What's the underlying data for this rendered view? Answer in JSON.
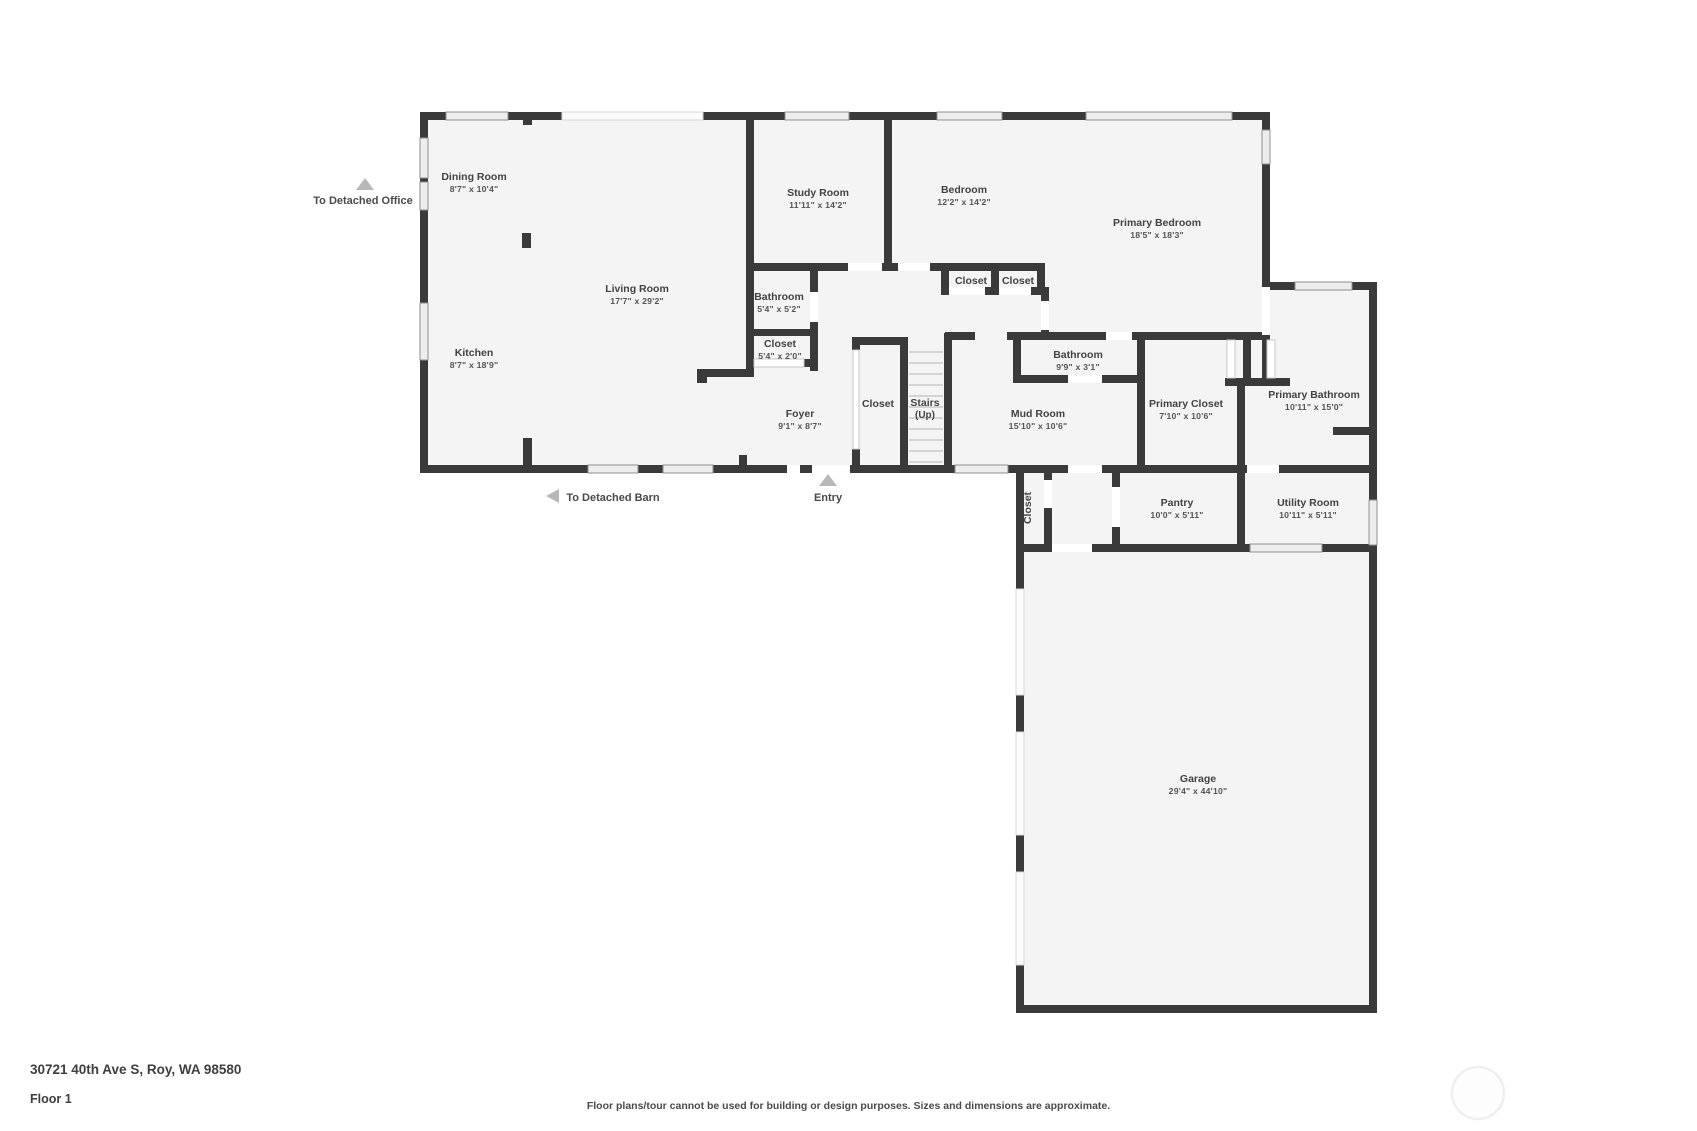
{
  "footer": {
    "address": "30721 40th Ave S, Roy, WA 98580",
    "floor": "Floor 1",
    "disclaimer": "Floor plans/tour cannot be used for building or design purposes. Sizes and dimensions are approximate."
  },
  "colors": {
    "wall": "#3a3a3a",
    "floor": "#f4f4f4",
    "arrow": "#b8b8b8",
    "label_text": "#424242"
  },
  "plan": {
    "labels": [
      {
        "id": "dining-room",
        "name": "Dining Room",
        "dims": "8'7\" x 10'4\"",
        "x": 474,
        "y": 180
      },
      {
        "id": "living-room",
        "name": "Living Room",
        "dims": "17'7\" x 29'2\"",
        "x": 637,
        "y": 292
      },
      {
        "id": "kitchen",
        "name": "Kitchen",
        "dims": "8'7\" x 18'9\"",
        "x": 474,
        "y": 356
      },
      {
        "id": "study-room",
        "name": "Study Room",
        "dims": "11'11\" x 14'2\"",
        "x": 818,
        "y": 196
      },
      {
        "id": "bedroom",
        "name": "Bedroom",
        "dims": "12'2\" x 14'2\"",
        "x": 964,
        "y": 193
      },
      {
        "id": "primary-bedroom",
        "name": "Primary Bedroom",
        "dims": "18'5\" x 18'3\"",
        "x": 1157,
        "y": 226
      },
      {
        "id": "bathroom-hall",
        "name": "Bathroom",
        "dims": "5'4\" x 5'2\"",
        "x": 779,
        "y": 300
      },
      {
        "id": "closet-hall",
        "name": "Closet",
        "dims": "5'4\" x 2'0\"",
        "x": 780,
        "y": 347
      },
      {
        "id": "closet-bedroom-1",
        "name": "Closet",
        "dims": "",
        "x": 971,
        "y": 284
      },
      {
        "id": "closet-bedroom-2",
        "name": "Closet",
        "dims": "",
        "x": 1018,
        "y": 284
      },
      {
        "id": "bathroom-mud",
        "name": "Bathroom",
        "dims": "9'9\" x 3'1\"",
        "x": 1078,
        "y": 358
      },
      {
        "id": "foyer",
        "name": "Foyer",
        "dims": "9'1\" x 8'7\"",
        "x": 800,
        "y": 417
      },
      {
        "id": "closet-foyer",
        "name": "Closet",
        "dims": "",
        "x": 878,
        "y": 407
      },
      {
        "id": "stairs",
        "name": "Stairs",
        "dims": "(Up)",
        "x": 925,
        "y": 406
      },
      {
        "id": "mud-room",
        "name": "Mud Room",
        "dims": "15'10\" x 10'6\"",
        "x": 1038,
        "y": 417
      },
      {
        "id": "primary-closet",
        "name": "Primary Closet",
        "dims": "7'10\" x 10'6\"",
        "x": 1186,
        "y": 407
      },
      {
        "id": "primary-bathroom",
        "name": "Primary Bathroom",
        "dims": "10'11\" x 15'0\"",
        "x": 1314,
        "y": 398
      },
      {
        "id": "closet-garage",
        "name": "Closet",
        "dims": "",
        "x": 1031,
        "y": 508,
        "rot": -90
      },
      {
        "id": "pantry",
        "name": "Pantry",
        "dims": "10'0\" x 5'11\"",
        "x": 1177,
        "y": 506
      },
      {
        "id": "utility-room",
        "name": "Utility Room",
        "dims": "10'11\" x 5'11\"",
        "x": 1308,
        "y": 506
      },
      {
        "id": "garage",
        "name": "Garage",
        "dims": "29'4\" x 44'10\"",
        "x": 1198,
        "y": 782
      }
    ],
    "annotations": [
      {
        "id": "to-detached-office",
        "label": "To Detached Office",
        "dir": "up",
        "ax": 365,
        "ay": 184,
        "tx": 363,
        "ty": 204
      },
      {
        "id": "to-detached-barn",
        "label": "To Detached Barn",
        "dir": "left",
        "ax": 553,
        "ay": 496,
        "tx": 613,
        "ty": 501
      },
      {
        "id": "entry",
        "label": "Entry",
        "dir": "up",
        "ax": 828,
        "ay": 480,
        "tx": 828,
        "ty": 501
      }
    ]
  }
}
